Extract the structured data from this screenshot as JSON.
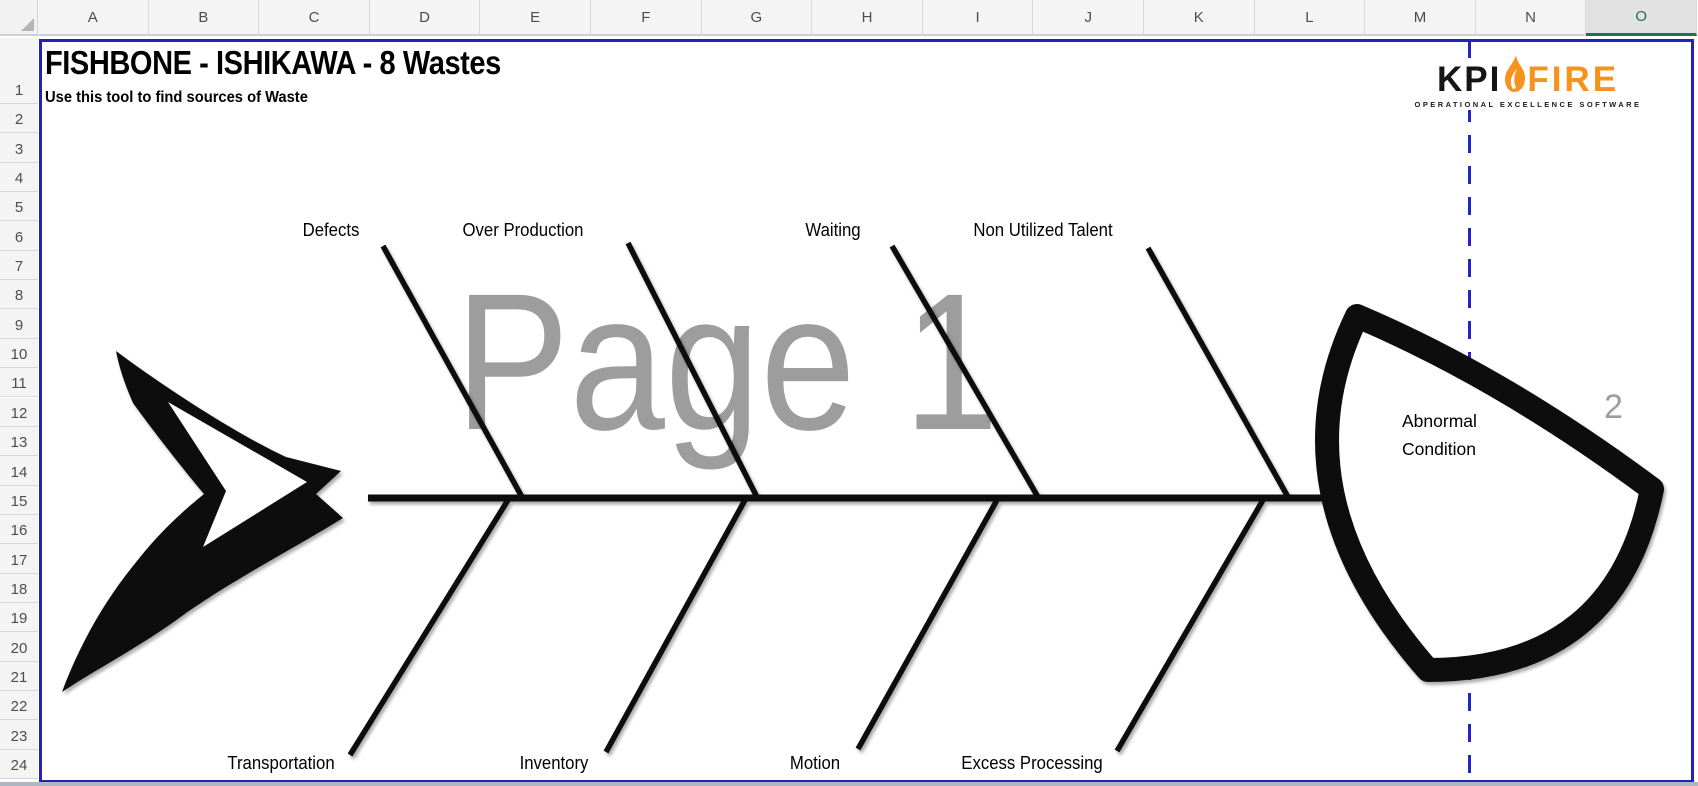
{
  "grid": {
    "column_headers": [
      "A",
      "B",
      "C",
      "D",
      "E",
      "F",
      "G",
      "H",
      "I",
      "J",
      "K",
      "L",
      "M",
      "N",
      "O"
    ],
    "row_headers": [
      "1",
      "2",
      "3",
      "4",
      "5",
      "6",
      "7",
      "8",
      "9",
      "10",
      "11",
      "12",
      "13",
      "14",
      "15",
      "16",
      "17",
      "18",
      "19",
      "20",
      "21",
      "22",
      "23",
      "24"
    ],
    "selected_column": "O",
    "selected_accent_color": "#217346"
  },
  "document": {
    "title": "FISHBONE - ISHIKAWA - 8 Wastes",
    "subtitle": "Use this tool to find sources of Waste"
  },
  "logo": {
    "kpi": "KPI",
    "fire": "FIRE",
    "tagline": "OPERATIONAL EXCELLENCE SOFTWARE",
    "fire_color": "#F6921E"
  },
  "watermarks": {
    "page1": "Page 1",
    "page2": "2"
  },
  "diagram": {
    "head_label": "Abnormal Condition",
    "top_bones": [
      "Defects",
      "Over Production",
      "Waiting",
      "Non Utilized Talent"
    ],
    "bottom_bones": [
      "Transportation",
      "Inventory",
      "Motion",
      "Excess Processing"
    ],
    "line_color": "#0b0b0b"
  },
  "page_break": {
    "border_color": "#2222bb"
  }
}
